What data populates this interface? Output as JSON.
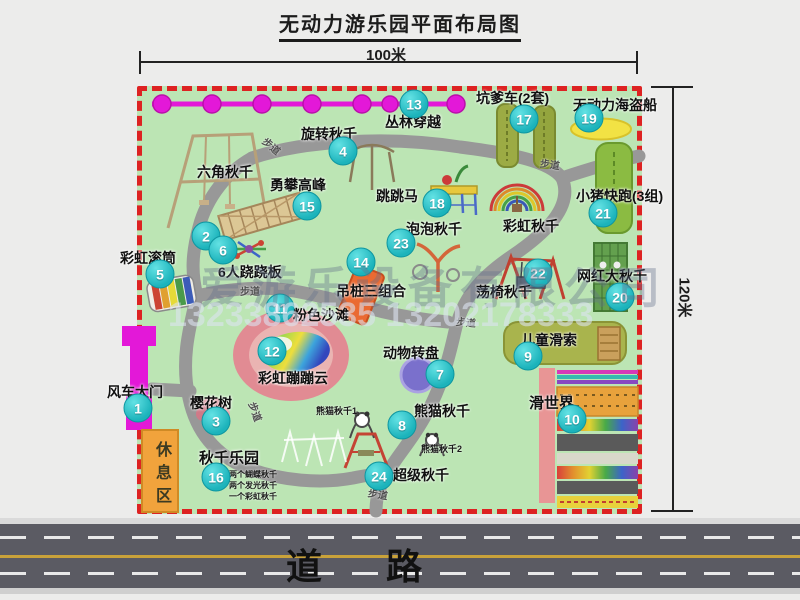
{
  "title": "无动力游乐园平面布局图",
  "dimensions": {
    "width_label": "100米",
    "height_label": "120米"
  },
  "road": {
    "label": "道　路"
  },
  "rest_area_label": "休息区",
  "watermark": {
    "company": "爱游乐设备有限公司",
    "phone": "13233862535 13202178333"
  },
  "colors": {
    "park_green": "#bce5b4",
    "border_red": "#dd2222",
    "badge_teal": "#1cb3bb",
    "gate_magenta": "#e318d8",
    "road_gray": "#5b5b63",
    "path_gray": "#989898"
  },
  "attractions": [
    {
      "num": 1,
      "name": "风车大门",
      "lx": 107,
      "ly": 382,
      "bx": 138,
      "by": 408
    },
    {
      "num": 2,
      "name": "六角秋千",
      "lx": 197,
      "ly": 162,
      "bx": 206,
      "by": 236
    },
    {
      "num": 3,
      "name": "樱花树",
      "lx": 190,
      "ly": 393,
      "bx": 216,
      "by": 421
    },
    {
      "num": 4,
      "name": "旋转秋千",
      "lx": 301,
      "ly": 124,
      "bx": 343,
      "by": 151
    },
    {
      "num": 5,
      "name": "彩虹滚筒",
      "lx": 120,
      "ly": 248,
      "bx": 160,
      "by": 274
    },
    {
      "num": 6,
      "name": "6人跷跷板",
      "lx": 218,
      "ly": 262,
      "bx": 223,
      "by": 250
    },
    {
      "num": 7,
      "name": "动物转盘",
      "lx": 383,
      "ly": 343,
      "bx": 440,
      "by": 374
    },
    {
      "num": 8,
      "name": "熊猫秋千",
      "lx": 414,
      "ly": 401,
      "bx": 402,
      "by": 425,
      "subs": [
        {
          "text": "熊猫秋千1",
          "x": 316,
          "y": 404
        },
        {
          "text": "熊猫秋千2",
          "x": 421,
          "y": 442
        }
      ]
    },
    {
      "num": 9,
      "name": "儿童滑索",
      "lx": 521,
      "ly": 330,
      "bx": 528,
      "by": 356
    },
    {
      "num": 10,
      "name": "滑世界",
      "lx": 529,
      "ly": 392,
      "bx": 572,
      "by": 419,
      "fs": 15
    },
    {
      "num": 11,
      "name": "粉色沙滩",
      "lx": 293,
      "ly": 305,
      "bx": 280,
      "by": 308
    },
    {
      "num": 12,
      "name": "彩虹蹦蹦云",
      "lx": 258,
      "ly": 368,
      "bx": 272,
      "by": 351
    },
    {
      "num": 13,
      "name": "丛林穿越",
      "lx": 385,
      "ly": 112,
      "bx": 414,
      "by": 104
    },
    {
      "num": 14,
      "name": "吊桩三组合",
      "lx": 336,
      "ly": 281,
      "bx": 361,
      "by": 262
    },
    {
      "num": 15,
      "name": "勇攀高峰",
      "lx": 270,
      "ly": 175,
      "bx": 307,
      "by": 206
    },
    {
      "num": 16,
      "name": "秋千乐园",
      "lx": 199,
      "ly": 447,
      "bx": 216,
      "by": 477,
      "fs": 15,
      "subs": [
        {
          "text": "两个蝴蝶秋千",
          "x": 229,
          "y": 469,
          "fs": 8
        },
        {
          "text": "两个发光秋千",
          "x": 229,
          "y": 480,
          "fs": 8
        },
        {
          "text": "一个彩虹秋千",
          "x": 229,
          "y": 491,
          "fs": 8
        }
      ]
    },
    {
      "num": 17,
      "name": "坑爹车(2套)",
      "lx": 476,
      "ly": 88,
      "bx": 524,
      "by": 119
    },
    {
      "num": 18,
      "name": "跳跳马",
      "lx": 376,
      "ly": 186,
      "bx": 437,
      "by": 203
    },
    {
      "num": 19,
      "name": "无动力海盗船",
      "lx": 573,
      "ly": 95,
      "bx": 589,
      "by": 118
    },
    {
      "num": 20,
      "name": "网红大秋千",
      "lx": 577,
      "ly": 266,
      "bx": 620,
      "by": 297
    },
    {
      "num": 21,
      "name": "小猪快跑(3组)",
      "lx": 576,
      "ly": 186,
      "bx": 603,
      "by": 213
    },
    {
      "num": 22,
      "name": "荡椅秋千",
      "lx": 476,
      "ly": 282,
      "bx": 538,
      "by": 273
    },
    {
      "num": 23,
      "name": "泡泡秋千",
      "lx": 406,
      "ly": 219,
      "bx": 401,
      "by": 243
    },
    {
      "num": 24,
      "name": "超级秋千",
      "lx": 393,
      "ly": 465,
      "bx": 379,
      "by": 476
    },
    {
      "num": null,
      "name": "彩虹秋千",
      "lx": 503,
      "ly": 216
    }
  ],
  "path_labels": [
    {
      "text": "步道",
      "x": 262,
      "y": 138,
      "rot": 40
    },
    {
      "text": "步道",
      "x": 540,
      "y": 156,
      "rot": 8
    },
    {
      "text": "步道",
      "x": 240,
      "y": 283,
      "rot": 0
    },
    {
      "text": "步道",
      "x": 456,
      "y": 314,
      "rot": 5
    },
    {
      "text": "步道",
      "x": 246,
      "y": 404,
      "rot": 70
    },
    {
      "text": "步道",
      "x": 368,
      "y": 486,
      "rot": 10
    }
  ]
}
